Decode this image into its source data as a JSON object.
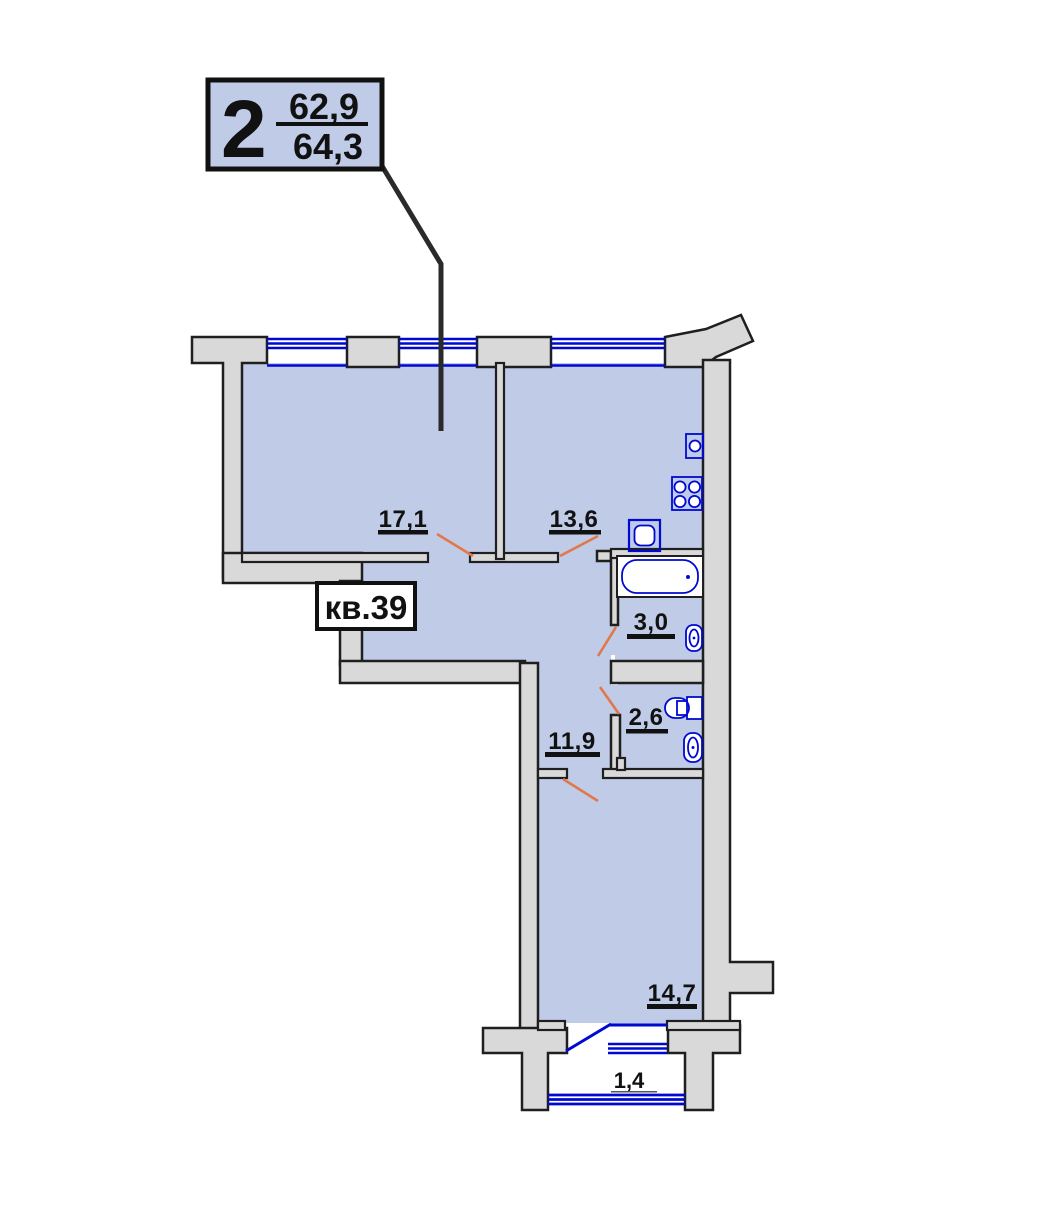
{
  "legend": {
    "room_count": "2",
    "living_area": "62,9",
    "total_area": "64,3"
  },
  "apartment_label": "кв.39",
  "rooms": {
    "living": {
      "area": "17,1"
    },
    "kitchen": {
      "area": "13,6"
    },
    "bathroom": {
      "area": "3,0"
    },
    "toilet": {
      "area": "2,6"
    },
    "hallway": {
      "area": "11,9"
    },
    "bedroom": {
      "area": "14,7"
    },
    "balcony": {
      "area": "1,4"
    }
  },
  "fixtures": [
    "kitchen-sink",
    "stove",
    "washbasin",
    "bathtub",
    "bathroom-sink",
    "toilet",
    "toilet-sink"
  ],
  "colors": {
    "room_fill": "#c0cbe8",
    "wall_fill": "#d9d9d9",
    "outline": "#1f1f1f",
    "window_blue": "#0009d2",
    "door_swing_orange": "#e0784a"
  }
}
